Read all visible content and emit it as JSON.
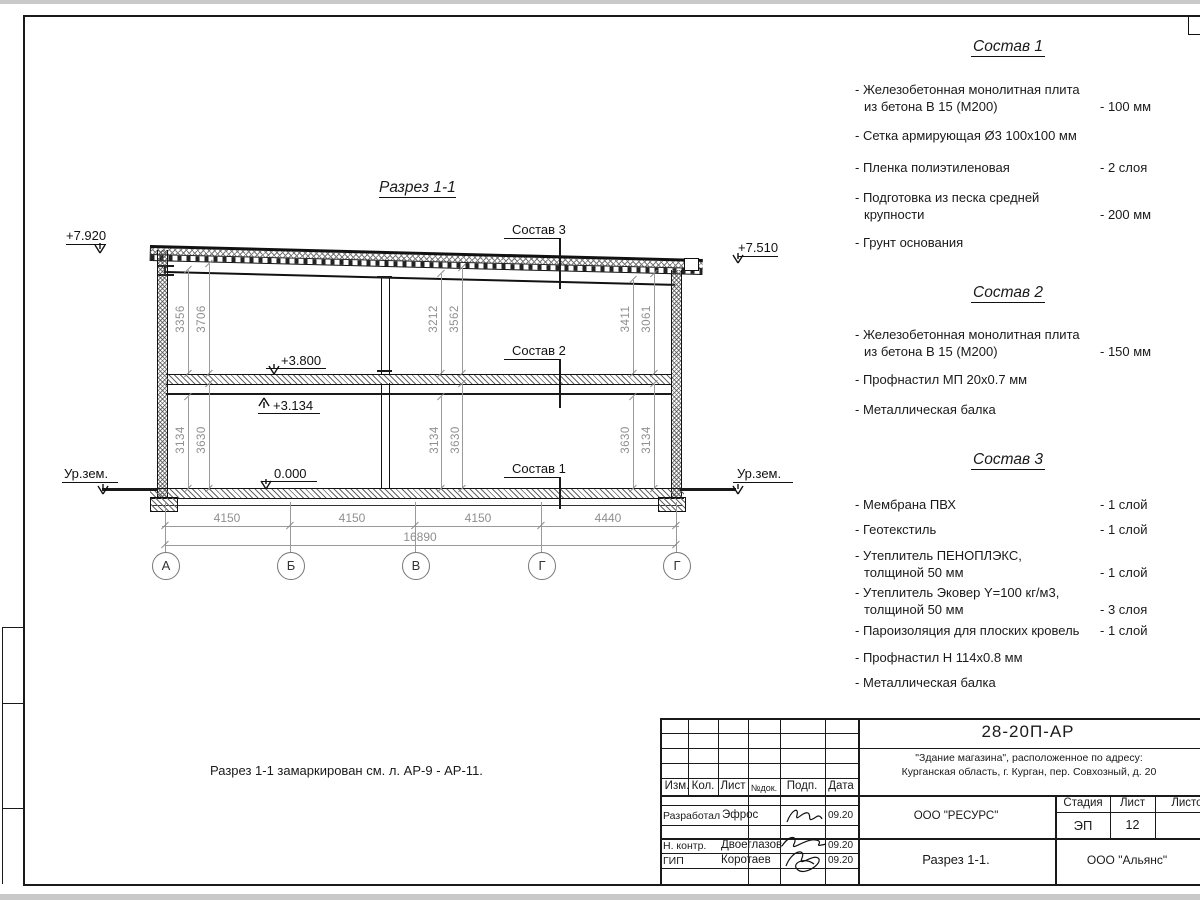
{
  "section": {
    "title": "Разрез 1-1",
    "note": "Разрез 1-1 замаркирован см. л. АР-9 - АР-11.",
    "leaders": {
      "l3": "Состав 3",
      "l2": "Состав 2",
      "l1": "Состав 1"
    },
    "elev": {
      "roof_left": "+7.920",
      "roof_right": "+7.510",
      "floor2_top": "+3.800",
      "floor2_beam": "+3.134",
      "floor1": "0.000",
      "ground_left": "Ур.зем.",
      "ground_right": "Ур.зем."
    },
    "vdims": {
      "lu1": "3356",
      "lu2": "3706",
      "mu1": "3212",
      "mu2": "3562",
      "ru1": "3411",
      "ru2": "3061",
      "ll1": "3134",
      "ll2": "3630",
      "ml1": "3134",
      "ml2": "3630",
      "rl1": "3630",
      "rl2": "3134"
    },
    "hdims": {
      "d1": "4150",
      "d2": "4150",
      "d3": "4150",
      "d4": "4440",
      "total": "16890"
    },
    "grid": {
      "g1": "А",
      "g2": "Б",
      "g3": "В",
      "g4": "Г",
      "g5": "Г"
    }
  },
  "comps": [
    {
      "title": "Состав 1",
      "items": [
        {
          "l1": "- Железобетонная  монолитная плита",
          "l2": "из бетона В 15 (М200)",
          "v": "- 100 мм"
        },
        {
          "l1": "- Сетка армирующая Ø3 100х100 мм",
          "l2": "",
          "v": ""
        },
        {
          "l1": "- Пленка полиэтиленовая",
          "l2": "",
          "v": "-  2 слоя"
        },
        {
          "l1": "- Подготовка из песка средней",
          "l2": "крупности",
          "v": "- 200 мм"
        },
        {
          "l1": "- Грунт основания",
          "l2": "",
          "v": ""
        }
      ]
    },
    {
      "title": "Состав 2",
      "items": [
        {
          "l1": "- Железобетонная  монолитная плита",
          "l2": "из бетона В 15 (М200)",
          "v": "- 150 мм"
        },
        {
          "l1": "- Профнастил МП 20х0.7 мм",
          "l2": "",
          "v": ""
        },
        {
          "l1": "- Металлическая балка",
          "l2": "",
          "v": ""
        }
      ]
    },
    {
      "title": "Состав 3",
      "items": [
        {
          "l1": "- Мембрана ПВХ",
          "l2": "",
          "v": "- 1 слой"
        },
        {
          "l1": "- Геотекстиль",
          "l2": "",
          "v": "- 1 слой"
        },
        {
          "l1": "- Утеплитель ПЕНОПЛЭКС,",
          "l2": "толщиной 50 мм",
          "v": "- 1 слой"
        },
        {
          "l1": "- Утеплитель Эковер Y=100 кг/м3,",
          "l2": "толщиной 50 мм",
          "v": "- 3 слоя"
        },
        {
          "l1": "- Пароизоляция для плоских кровель",
          "l2": "",
          "v": "- 1 слой"
        },
        {
          "l1": "- Профнастил Н 114х0.8 мм",
          "l2": "",
          "v": ""
        },
        {
          "l1": "- Металлическая балка",
          "l2": "",
          "v": ""
        }
      ]
    }
  ],
  "tb": {
    "doc": "28-20П-АР",
    "obj1": "\"Здание магазина\", расположенное по адресу:",
    "obj2": "Курганская область, г. Курган, пер. Совхозный, д. 20",
    "org": "ООО \"РЕСУРС\"",
    "sheet_title": "Разрез 1-1.",
    "contractor": "ООО \"Альянс\"",
    "cols": {
      "c1": "Изм.",
      "c2": "Кол.",
      "c3": "Лист",
      "c4": "№док.",
      "c5": "Подп.",
      "c6": "Дата"
    },
    "stage_label": "Стадия",
    "sheet_label": "Лист",
    "sheets_label": "Листов",
    "stage": "ЭП",
    "sheet_no": "12",
    "r1": {
      "role": "Разработал",
      "name": "Эфрос",
      "date": "09.20"
    },
    "r2": {
      "role": "Н. контр.",
      "name": "Двоеглазов",
      "date": "09.20"
    },
    "r3": {
      "role": "ГИП",
      "name": "Коротаев",
      "date": "09.20"
    }
  }
}
